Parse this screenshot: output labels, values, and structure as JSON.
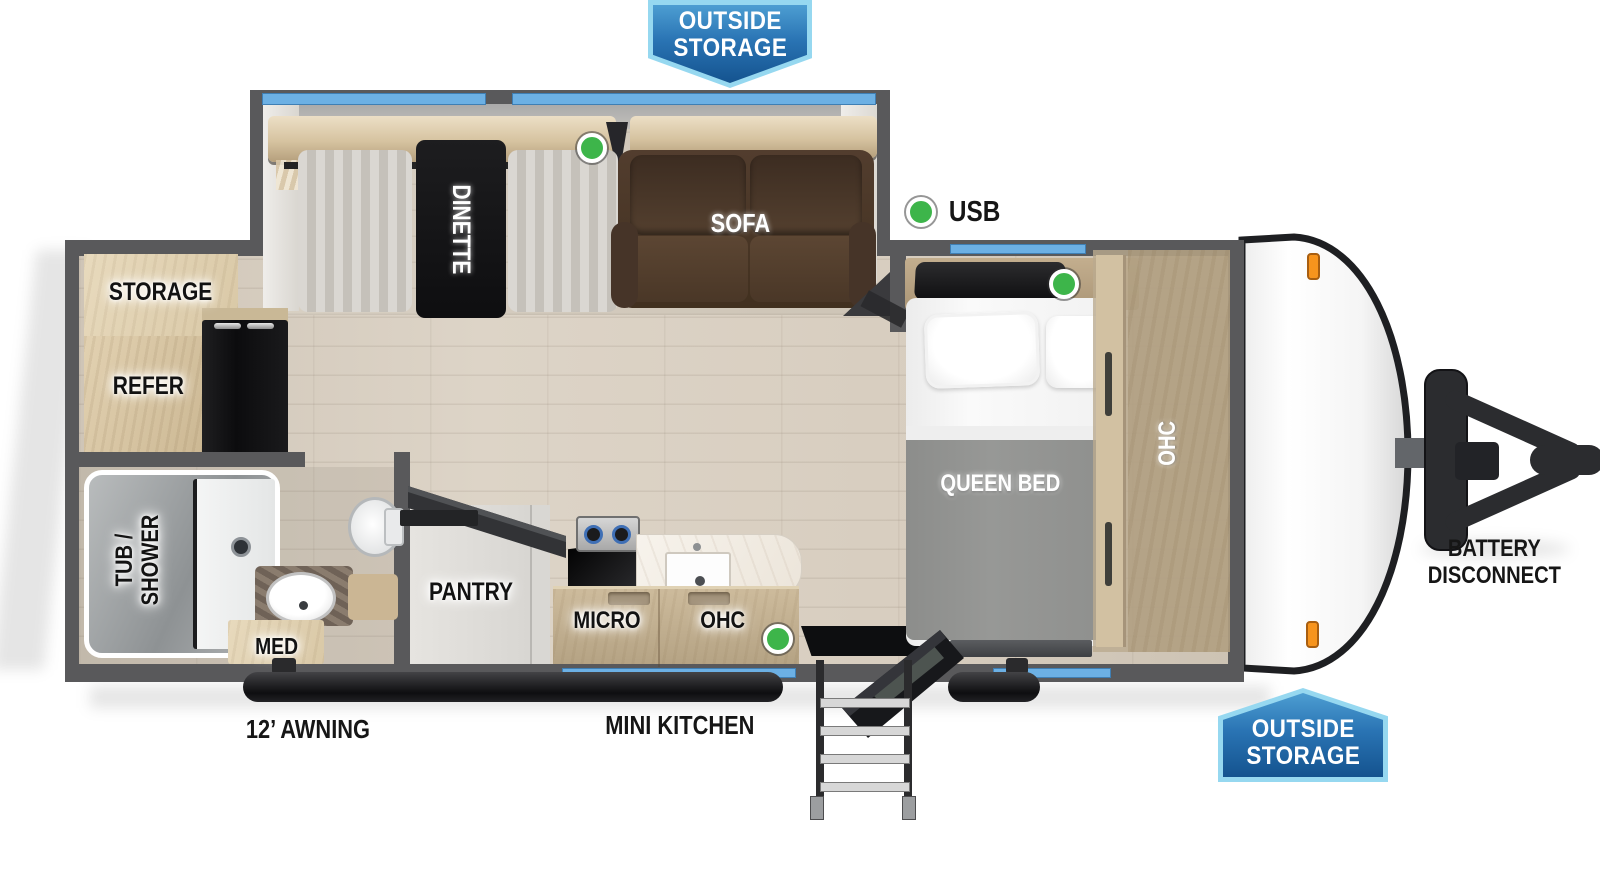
{
  "badges": {
    "top": {
      "line1": "OUTSIDE",
      "line2": "STORAGE"
    },
    "bottom_right": {
      "line1": "OUTSIDE",
      "line2": "STORAGE"
    }
  },
  "legend": {
    "usb_label": "USB"
  },
  "labels": {
    "dinette": "DINETTE",
    "sofa": "SOFA",
    "storage": "STORAGE",
    "refer": "REFER",
    "tub_shower_line1": "TUB /",
    "tub_shower_line2": "SHOWER",
    "med": "MED",
    "pantry": "PANTRY",
    "micro": "MICRO",
    "ohc_kitchen": "OHC",
    "ohc_bedroom": "OHC",
    "queen_bed": "QUEEN BED"
  },
  "exterior": {
    "awning": "12’ AWNING",
    "mini_kitchen": "MINI KITCHEN",
    "battery_line1": "BATTERY",
    "battery_line2": "DISCONNECT"
  },
  "colors": {
    "wall": "#59595b",
    "window_blue": "#6cb0e4",
    "badge_border": "#96d8f0",
    "badge_blue": "#14538f",
    "usb_dot_green": "#3db54a",
    "marker_light_orange": "#f7941d",
    "sofa_brown": "#4c392c",
    "table_black": "#161616"
  }
}
